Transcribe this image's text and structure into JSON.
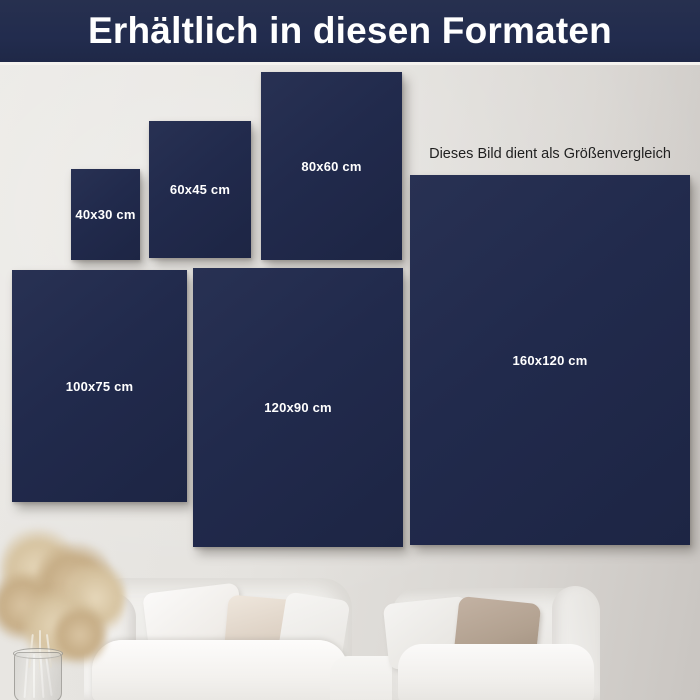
{
  "header": {
    "title": "Erhältlich in diesen Formaten"
  },
  "note": {
    "text": "Dieses Bild dient als Größenvergleich"
  },
  "colors": {
    "canvas_navy": "#212a4c",
    "header_navy": "#222c4e",
    "wall_light": "#e6e4e0",
    "wall_dark": "#c9c5c1",
    "label_text": "#ffffff",
    "note_text": "#1f1f1f"
  },
  "formats": [
    {
      "label": "40x30 cm",
      "x": 71,
      "y": 169,
      "w": 69,
      "h": 91
    },
    {
      "label": "60x45 cm",
      "x": 149,
      "y": 121,
      "w": 102,
      "h": 137
    },
    {
      "label": "80x60 cm",
      "x": 261,
      "y": 72,
      "w": 141,
      "h": 188
    },
    {
      "label": "100x75 cm",
      "x": 12,
      "y": 270,
      "w": 175,
      "h": 232
    },
    {
      "label": "120x90 cm",
      "x": 193,
      "y": 268,
      "w": 210,
      "h": 279
    },
    {
      "label": "160x120 cm",
      "x": 410,
      "y": 175,
      "w": 280,
      "h": 370
    }
  ],
  "scene": {
    "objects": [
      "pampas-grass-left",
      "glass-vase",
      "sofa-left",
      "pillow-white",
      "pillow-beige",
      "sofa-right",
      "pillow-taupe",
      "pampas-grass-center",
      "ceramic-vase",
      "side-table"
    ]
  }
}
